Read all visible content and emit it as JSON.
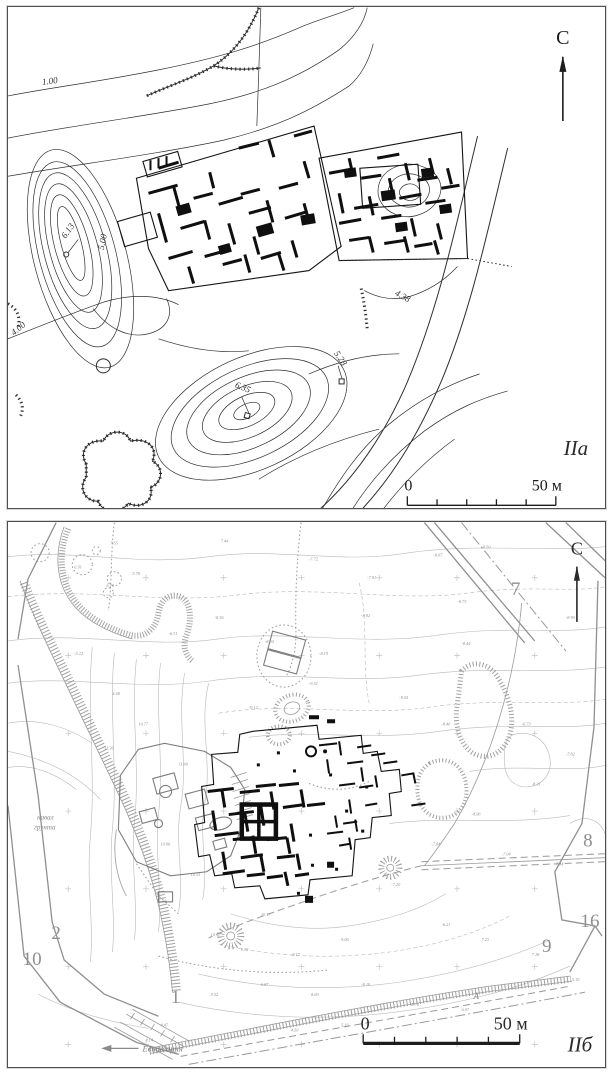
{
  "figure": {
    "type": "archaeological site plans, two framed map panels"
  },
  "colors": {
    "paper": "#ffffff",
    "ink": "#2f2f2f",
    "excavation_black": "#0f0f0f",
    "map_gray": "#9a9a9a",
    "label_gray": "#909090",
    "panel_border": "#4f4f4f"
  },
  "panel_a": {
    "caption": "IIа",
    "north_label": "С",
    "scale_bar": {
      "zero": "0",
      "end": "50 м"
    },
    "contour_labels": [
      {
        "value": "1.00",
        "x": 42,
        "y": 76,
        "r": -8
      },
      {
        "value": "6.13",
        "x": 62,
        "y": 224,
        "r": -55
      },
      {
        "value": "5.00",
        "x": 97,
        "y": 234,
        "r": -78
      },
      {
        "value": "4.00",
        "x": 12,
        "y": 322,
        "r": -40
      },
      {
        "value": "6.35",
        "x": 233,
        "y": 381,
        "r": 22
      },
      {
        "value": "5.28",
        "x": 329,
        "y": 351,
        "r": 55
      },
      {
        "value": "4.38",
        "x": 392,
        "y": 290,
        "r": 28
      }
    ]
  },
  "panel_b": {
    "caption": "IIб",
    "north_label": "С",
    "scale_bar": {
      "zero": "0",
      "end": "50 м"
    },
    "site_numbers": [
      {
        "value": "7",
        "x": 506,
        "y": 72
      },
      {
        "value": "8",
        "x": 578,
        "y": 323
      },
      {
        "value": "16",
        "x": 580,
        "y": 403
      },
      {
        "value": "9",
        "x": 537,
        "y": 428
      },
      {
        "value": "2",
        "x": 48,
        "y": 415
      },
      {
        "value": "10",
        "x": 24,
        "y": 441
      },
      {
        "value": "1",
        "x": 167,
        "y": 479
      }
    ],
    "text_labels": [
      {
        "value": "навал",
        "x": 29,
        "y": 296
      },
      {
        "value": "грунта",
        "x": 26,
        "y": 306
      }
    ],
    "road_label": "Евпатория",
    "rampart_label": "А",
    "spot_elevations": [
      {
        "value": "6.91",
        "x": 66,
        "y": 46
      },
      {
        "value": "7.65",
        "x": 102,
        "y": 22
      },
      {
        "value": "6.70",
        "x": 98,
        "y": 64
      },
      {
        "value": "5.78",
        "x": 124,
        "y": 52
      },
      {
        "value": "7.44",
        "x": 212,
        "y": 20
      },
      {
        "value": "-7.72",
        "x": 300,
        "y": 38
      },
      {
        "value": "-7.91",
        "x": 358,
        "y": 56
      },
      {
        "value": "-8.67",
        "x": 424,
        "y": 34
      },
      {
        "value": "-8.50",
        "x": 472,
        "y": 26
      },
      {
        "value": "-8.90",
        "x": 556,
        "y": 96
      },
      {
        "value": "-8.44",
        "x": 452,
        "y": 122
      },
      {
        "value": "-8.92",
        "x": 352,
        "y": 94
      },
      {
        "value": "-8.19",
        "x": 310,
        "y": 132
      },
      {
        "value": "-8.34",
        "x": 256,
        "y": 120
      },
      {
        "value": "-8.56",
        "x": 206,
        "y": 96
      },
      {
        "value": "-6.31",
        "x": 160,
        "y": 112
      },
      {
        "value": "-5.12",
        "x": 66,
        "y": 132
      },
      {
        "value": "4.68",
        "x": 104,
        "y": 172
      },
      {
        "value": "-8.73",
        "x": 448,
        "y": 80
      },
      {
        "value": "10.77",
        "x": 130,
        "y": 202
      },
      {
        "value": "11.36",
        "x": 96,
        "y": 226
      },
      {
        "value": "11.60",
        "x": 170,
        "y": 242
      },
      {
        "value": "-9.12",
        "x": 240,
        "y": 186
      },
      {
        "value": "-9.51",
        "x": 300,
        "y": 162
      },
      {
        "value": "-9.05",
        "x": 390,
        "y": 176
      },
      {
        "value": "-8.46",
        "x": 432,
        "y": 202
      },
      {
        "value": "-6.73",
        "x": 512,
        "y": 202
      },
      {
        "value": "-7.82",
        "x": 556,
        "y": 232
      },
      {
        "value": "-8.31",
        "x": 522,
        "y": 262
      },
      {
        "value": "-8.96",
        "x": 462,
        "y": 292
      },
      {
        "value": "-7.84",
        "x": 422,
        "y": 322
      },
      {
        "value": "-7.04",
        "x": 492,
        "y": 332
      },
      {
        "value": "7.34",
        "x": 546,
        "y": 342
      },
      {
        "value": "-7.20",
        "x": 382,
        "y": 362
      },
      {
        "value": "10.55",
        "x": 182,
        "y": 352
      },
      {
        "value": "10.96",
        "x": 152,
        "y": 322
      },
      {
        "value": "10.17",
        "x": 252,
        "y": 392
      },
      {
        "value": "10.11",
        "x": 202,
        "y": 412
      },
      {
        "value": "8.72",
        "x": 232,
        "y": 427
      },
      {
        "value": "-8.17",
        "x": 282,
        "y": 432
      },
      {
        "value": "9.06",
        "x": 332,
        "y": 417
      },
      {
        "value": "-6.21",
        "x": 432,
        "y": 402
      },
      {
        "value": "7.23",
        "x": 472,
        "y": 417
      },
      {
        "value": "7.18",
        "x": 522,
        "y": 432
      },
      {
        "value": "5.19",
        "x": 562,
        "y": 457
      },
      {
        "value": "-8.19",
        "x": 352,
        "y": 462
      },
      {
        "value": "8.69",
        "x": 302,
        "y": 472
      },
      {
        "value": "6.87",
        "x": 252,
        "y": 462
      },
      {
        "value": "9.52",
        "x": 202,
        "y": 472
      },
      {
        "value": "5.70",
        "x": 402,
        "y": 482
      },
      {
        "value": "6.07",
        "x": 452,
        "y": 487
      },
      {
        "value": "5.16",
        "x": 332,
        "y": 502
      },
      {
        "value": "4.50",
        "x": 282,
        "y": 507
      },
      {
        "value": "4.47",
        "x": 152,
        "y": 502
      },
      {
        "value": "4.14",
        "x": 137,
        "y": 517
      }
    ]
  }
}
